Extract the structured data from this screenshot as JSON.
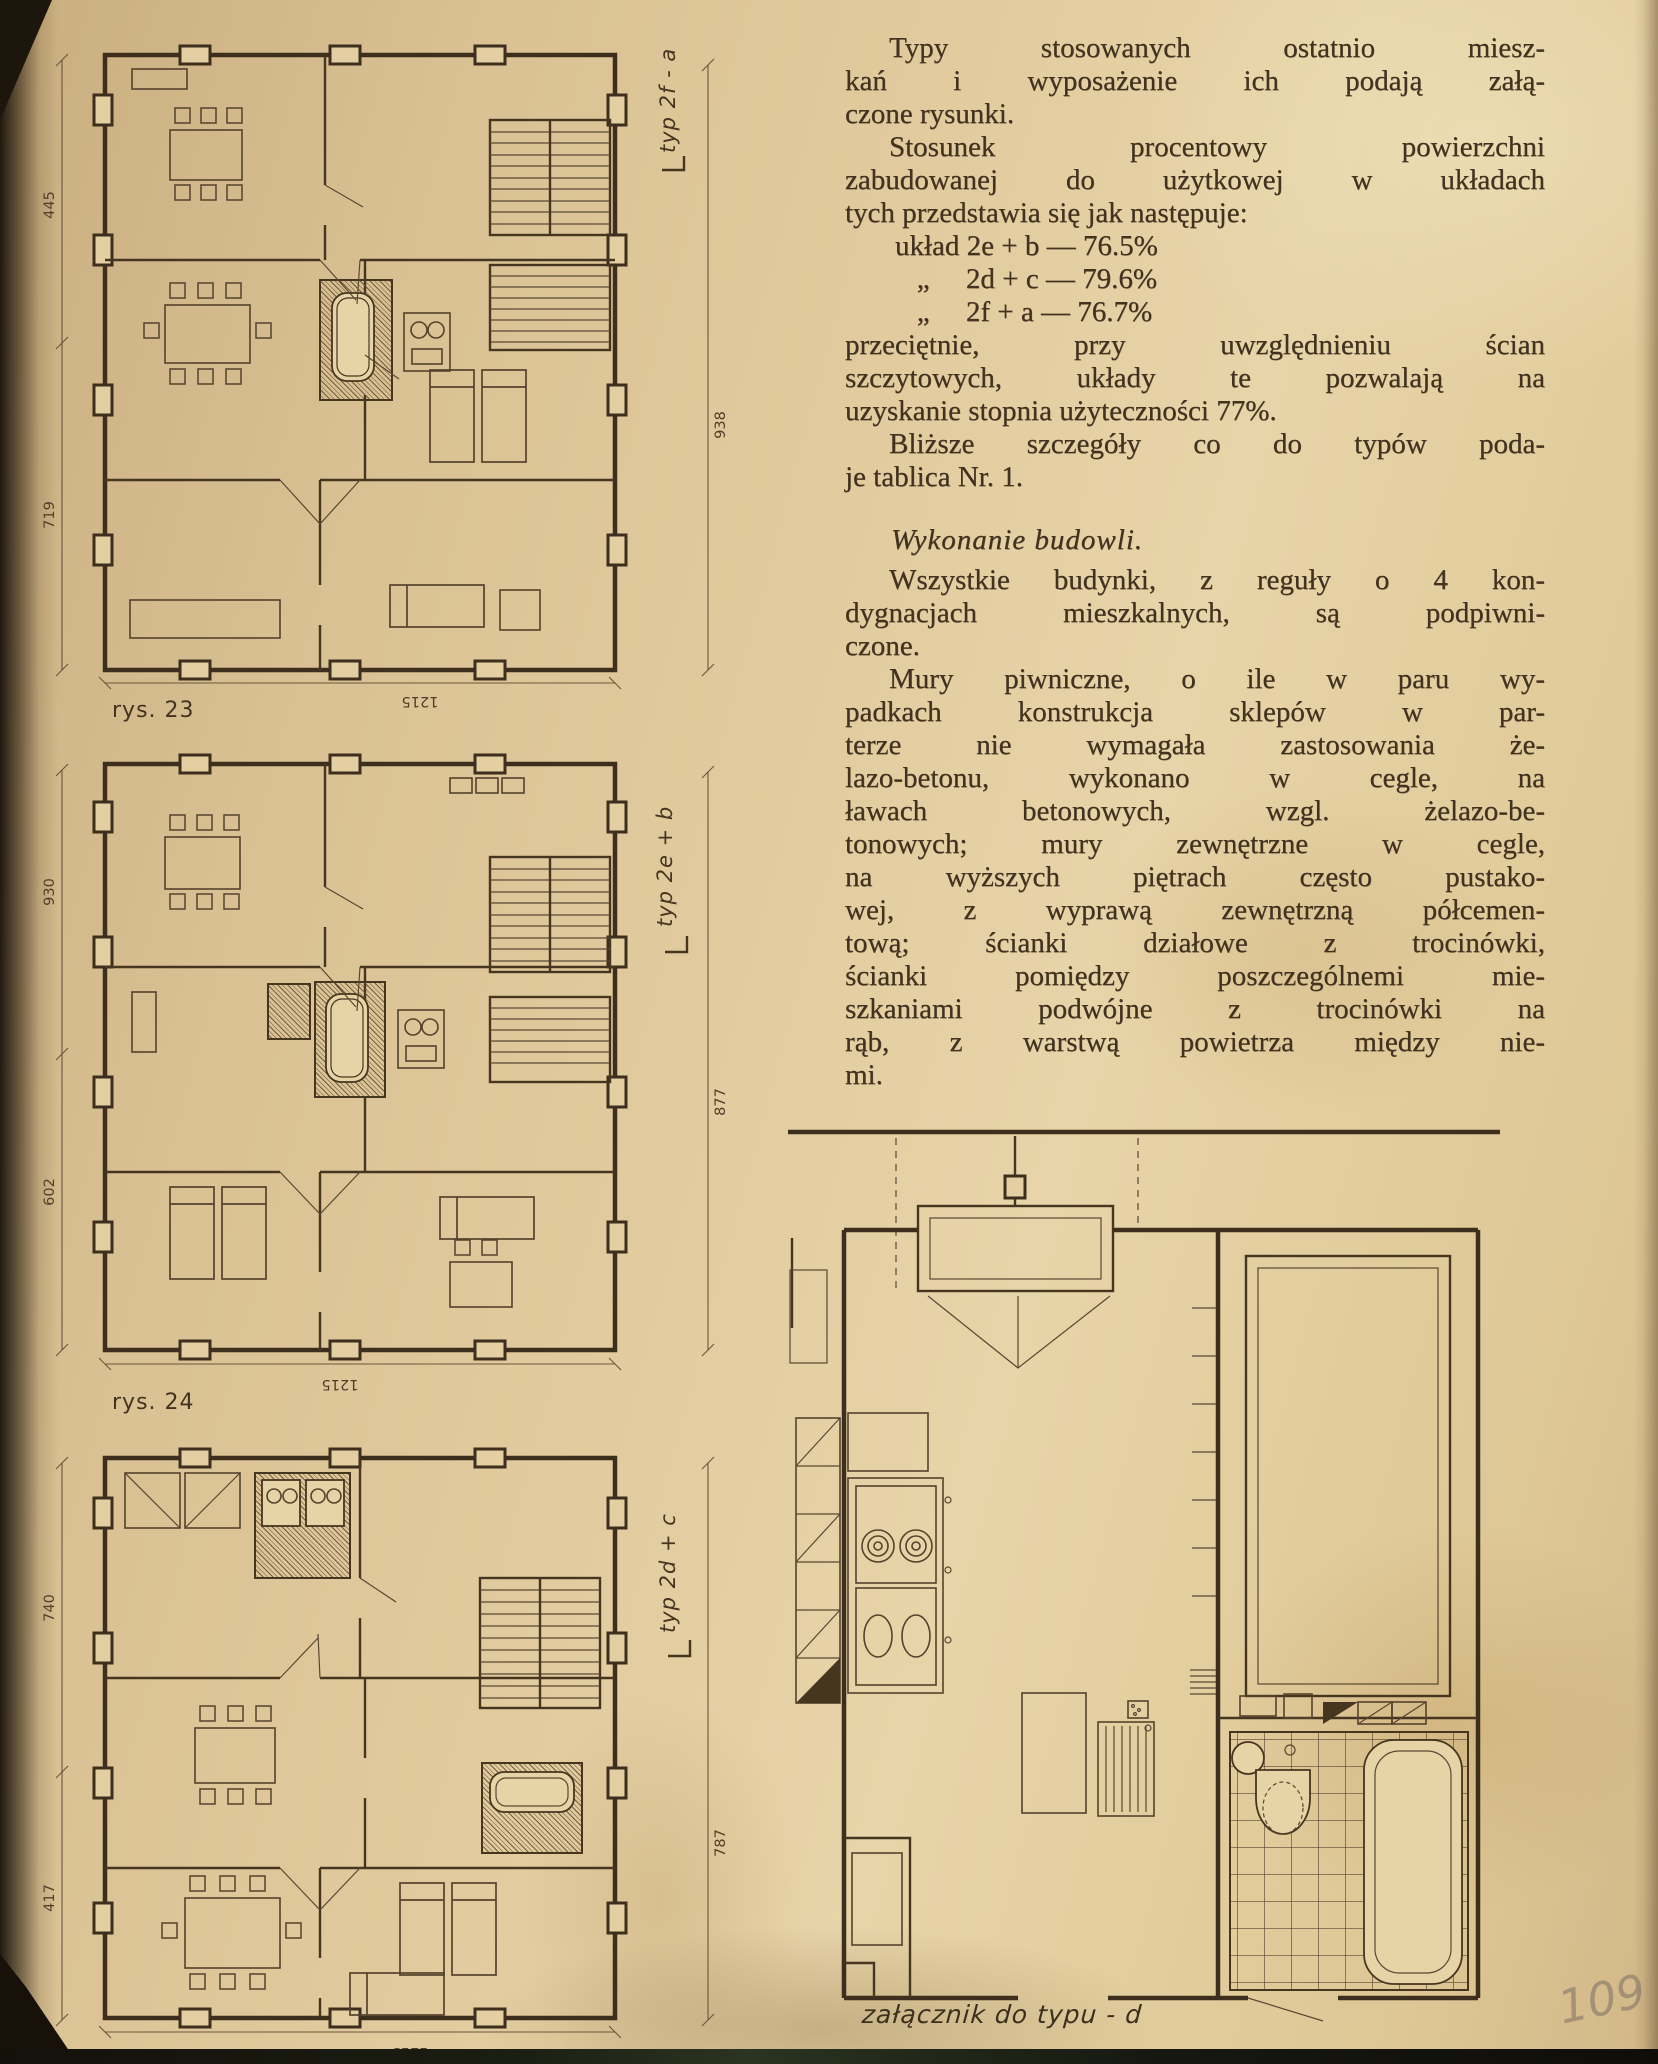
{
  "page": {
    "handwritten_number": "109",
    "paper_color": "#e2cc9f",
    "ink_color": "#46351f",
    "pencil_color": "#7a7064"
  },
  "article": {
    "paragraphs": [
      {
        "style": "indent",
        "lines": [
          "Typy stosowanych ostatnio miesz-",
          "kań i wyposażenie ich podają załą-",
          "czone rysunki."
        ]
      },
      {
        "style": "indent",
        "lines": [
          "Stosunek procentowy powierzchni",
          "zabudowanej do użytkowej w układach",
          "tych przedstawia się jak następuje:"
        ]
      },
      {
        "style": "list",
        "lines": [
          "układ 2e + b — 76.5%",
          "   „     2d + c — 79.6%",
          "   „     2f + a — 76.7%"
        ]
      },
      {
        "style": "plain",
        "lines": [
          "przeciętnie, przy uwzględnieniu ścian",
          "szczytowych, układy te pozwalają na",
          "uzyskanie stopnia użyteczności 77%."
        ]
      },
      {
        "style": "indent",
        "lines": [
          "Bliższe szczegóły co do typów poda-",
          "je tablica Nr. 1."
        ]
      },
      {
        "style": "heading",
        "lines": [
          "Wykonanie budowli."
        ]
      },
      {
        "style": "indent",
        "lines": [
          "Wszystkie budynki, z reguły o 4 kon-",
          "dygnacjach mieszkalnych, są podpiwni-",
          "czone."
        ]
      },
      {
        "style": "indent",
        "lines": [
          "Mury piwniczne, o ile w paru wy-",
          "padkach konstrukcja sklepów w par-",
          "terze nie wymagała zastosowania że-",
          "lazo-betonu, wykonano w cegle, na",
          "ławach betonowych, wzgl. żelazo-be-",
          "tonowych; mury zewnętrzne w cegle,",
          "na wyższych piętrach często pustako-",
          "wej, z wyprawą zewnętrzną półcemen-",
          "tową; ścianki działowe z trocinówki,",
          "ścianki pomiędzy poszczególnemi mie-",
          "szkaniami podwójne z trocinówki na",
          "rąb, z warstwą powietrza między nie-",
          "mi."
        ]
      }
    ]
  },
  "figures": {
    "plan1": {
      "caption": "rys. 23",
      "type_label": "typ 2f - a",
      "dim_left_top": "445",
      "dim_left_bottom": "719",
      "dim_right": "938",
      "dim_bottom": "1215"
    },
    "plan2": {
      "caption": "rys. 24",
      "type_label": "typ 2e + b",
      "dim_left_top": "930",
      "dim_left_bottom": "602",
      "dim_right": "877",
      "dim_bottom": "1215"
    },
    "plan3": {
      "type_label": "typ 2d + c",
      "dim_left_top": "740",
      "dim_left_bottom": "417",
      "dim_right": "787",
      "dim_bottom": "1213"
    },
    "detail": {
      "caption": "załącznik do typu - d"
    }
  }
}
